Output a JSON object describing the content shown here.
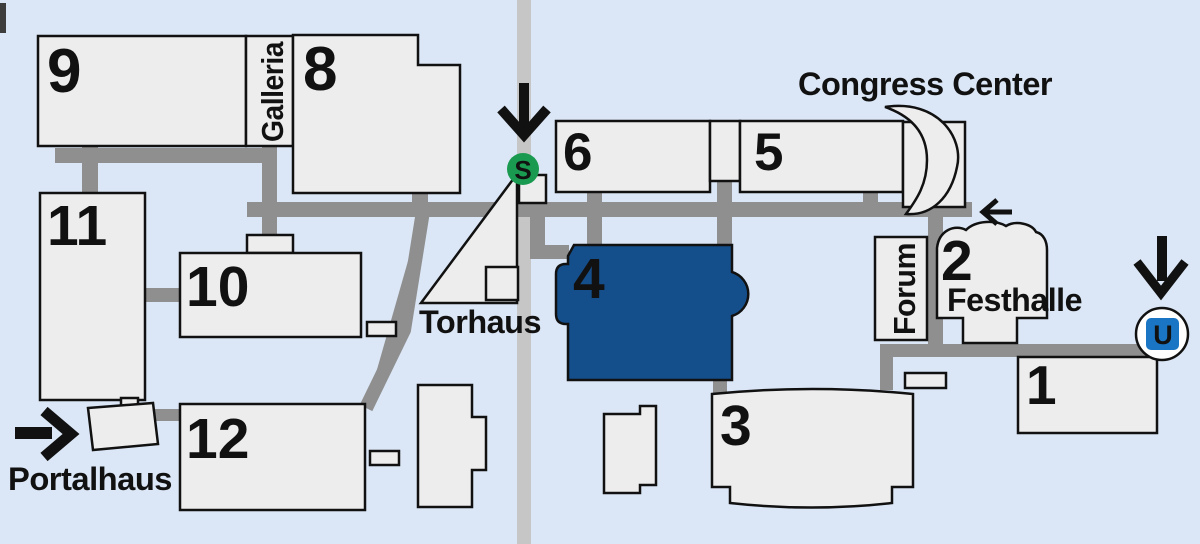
{
  "map": {
    "labels": {
      "congress_center": "Congress Center",
      "galleria": "Galleria",
      "torhaus": "Torhaus",
      "portalhaus": "Portalhaus",
      "festhalle": "Festhalle",
      "forum": "Forum"
    },
    "halls": {
      "h1": "1",
      "h2": "2",
      "h3": "3",
      "h4": "4",
      "h5": "5",
      "h6": "6",
      "h8": "8",
      "h9": "9",
      "h10": "10",
      "h11": "11",
      "h12": "12"
    },
    "highlighted_hall": "4",
    "transit": {
      "sbahn_label": "S",
      "ubahn_label": "U"
    },
    "icons": {
      "sbahn_entrance_arrow": "arrow-down",
      "ubahn_entrance_arrow": "arrow-down",
      "portalhaus_entrance_arrow": "arrow-right",
      "festhalle_entrance_arrow": "arrow-left"
    },
    "colors": {
      "background": "#dbe7f6",
      "building_fill": "#ededed",
      "road_gray": "#8f8f8f",
      "street_gray": "#c6c6c6",
      "hall_highlight": "#154f8b",
      "hall_highlight_text": "#ffffff",
      "sbahn_green": "#1a9a50",
      "ubahn_blue": "#1a75c4",
      "outline_black": "#111111"
    }
  }
}
